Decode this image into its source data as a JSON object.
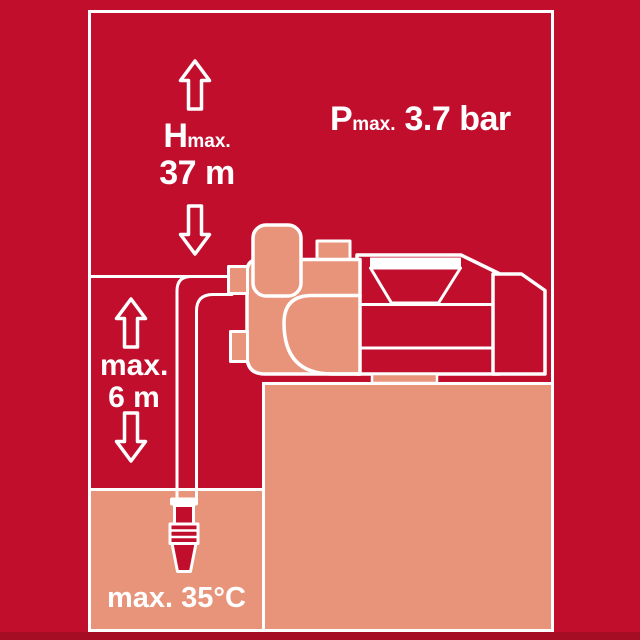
{
  "infographic": {
    "title": "pump-specification-infographic",
    "head_max": {
      "symbol": "H",
      "subscript": "max.",
      "value": "37 m"
    },
    "pressure_max": {
      "symbol": "P",
      "subscript": "max.",
      "value": "3.7 bar"
    },
    "suction_depth": {
      "prefix": "max.",
      "value": "6 m"
    },
    "water_temp_max": {
      "value": "max. 35°C"
    }
  },
  "icons": {
    "arrow_up_icon": "⇧ outlined block arrow",
    "arrow_down_icon": "⇩ outlined block arrow",
    "pump_icon": "jet garden pump line drawing",
    "foot_valve_icon": "suction hose strainer"
  },
  "colors": {
    "background_red": "#c10e2c",
    "accent_salmon": "#e8947a",
    "line_white": "#ffffff",
    "footer_dark_red": "#a50d24"
  }
}
